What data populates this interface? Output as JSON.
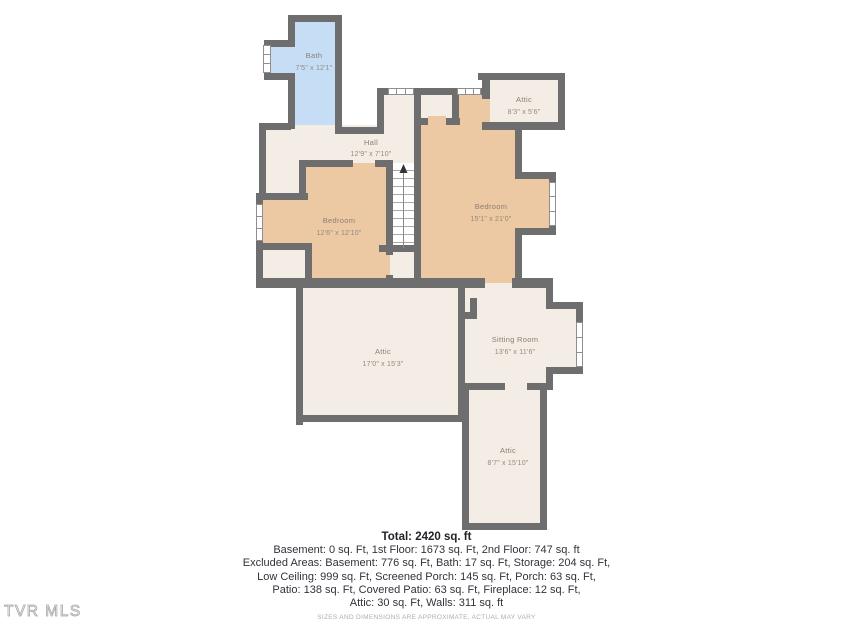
{
  "floorplan": {
    "rooms": [
      {
        "id": "bath",
        "label": "Bath",
        "dims": "7'5\" x 12'1\""
      },
      {
        "id": "hall",
        "label": "Hall",
        "dims": "12'9\" x 7'10\""
      },
      {
        "id": "attic-top",
        "label": "Attic",
        "dims": "8'3\" x 5'6\""
      },
      {
        "id": "bedroom-left",
        "label": "Bedroom",
        "dims": "12'6\" x 12'10\""
      },
      {
        "id": "bedroom-right",
        "label": "Bedroom",
        "dims": "15'1\" x 21'0\""
      },
      {
        "id": "attic-middle",
        "label": "Attic",
        "dims": "17'0\" x 15'3\""
      },
      {
        "id": "sitting-room",
        "label": "Sitting Room",
        "dims": "13'6\" x 11'6\""
      },
      {
        "id": "attic-bottom",
        "label": "Attic",
        "dims": "8'7\" x 15'10\""
      }
    ],
    "colors": {
      "wall": "#6e6e6e",
      "bath_fill": "#c5def5",
      "bedroom_fill": "#ecc8a3",
      "room_fill": "#f4ede6"
    }
  },
  "summary": {
    "total": "Total: 2420 sq. ft",
    "lines": [
      "Basement: 0 sq. Ft, 1st Floor: 1673 sq. Ft, 2nd Floor: 747 sq. ft",
      "Excluded Areas: Basement: 776 sq. Ft, Bath: 17 sq. Ft, Storage: 204 sq. Ft,",
      "Low Ceiling: 999 sq. Ft, Screened Porch: 145 sq. Ft, Porch: 63 sq. Ft,",
      "Patio: 138 sq. Ft, Covered Patio: 63 sq. Ft, Fireplace: 12 sq. Ft,",
      "Attic: 30 sq. Ft, Walls: 311 sq. ft"
    ],
    "disclaimer": "SIZES AND DIMENSIONS ARE APPROXIMATE, ACTUAL MAY VARY"
  },
  "watermark": "TVR MLS"
}
